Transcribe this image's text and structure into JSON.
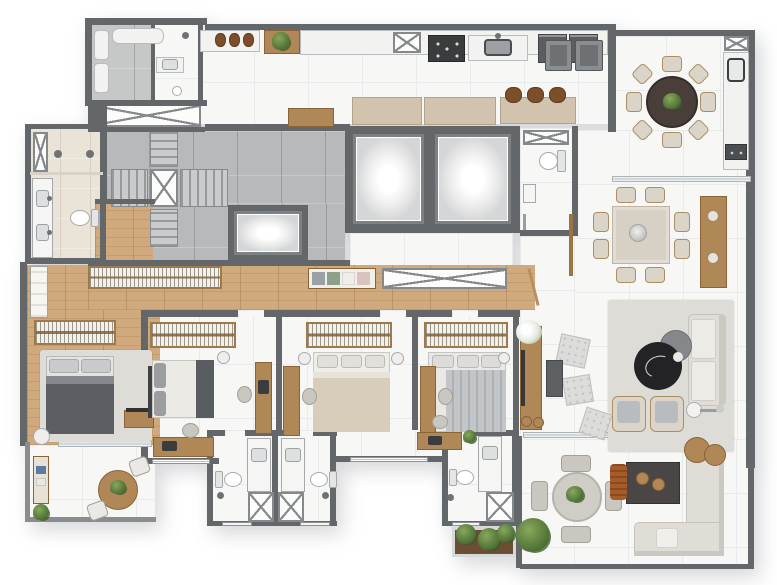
{
  "meta": {
    "kind": "architectural-floor-plan",
    "view": "top-down rendered apartment plan",
    "visible_text": "none"
  },
  "palette": {
    "wall": "#63676a",
    "wallmid": "#8a8d8f",
    "marble": "#f7f7f6",
    "marblegrid": "#e9eaec",
    "wood": "#d0aa7d",
    "concrete": "#b7b9ba",
    "beige": "#eae3d7",
    "furnwood": "#b08756",
    "tan": "#d2c3ae",
    "darkfurn": "#4a4645",
    "sofa": "#e0ddd7",
    "rug": "#dedcd7",
    "green": "#5c7d42",
    "stool_brown": "#7c4e2a",
    "orange": "#a55c28",
    "bed_dark": "#5b5e62",
    "table_dark": "#4a3e3a",
    "coffee_black": "#232225"
  },
  "counts": {
    "bedrooms": 4,
    "bathrooms_total": 6,
    "passenger_elevators": 2,
    "service_elevators": 1,
    "dining_table_seats": 8,
    "balcony_round_table_seats": 8,
    "terrace_round_table_seats": 4,
    "kitchen_bar_stools": 3
  },
  "rooms": [
    {
      "id": "service-room",
      "furniture": [
        "water-heaters",
        "stacked-machines"
      ]
    },
    {
      "id": "service-bathroom",
      "furniture": [
        "shower-head",
        "sink",
        "drain"
      ]
    },
    {
      "id": "laundry",
      "furniture": [
        "counter",
        "baskets",
        "plant-shelf"
      ]
    },
    {
      "id": "kitchen",
      "furniture": [
        "counter",
        "cooktop-5-burners",
        "sink",
        "ovens",
        "bar-counter",
        "bar-stools",
        "cabinets",
        "entry-cabinets"
      ]
    },
    {
      "id": "gourmet-balcony",
      "furniture": [
        "round-dining-table",
        "eight-chairs",
        "counter-sink",
        "grill",
        "duct"
      ]
    },
    {
      "id": "stair-core",
      "furniture": [
        "switchback-stairs",
        "shaft",
        "service-elevator"
      ]
    },
    {
      "id": "elevator-hall",
      "furniture": [
        "elevator-1",
        "elevator-2"
      ]
    },
    {
      "id": "powder-room",
      "furniture": [
        "toilet",
        "sink",
        "duct"
      ]
    },
    {
      "id": "dining-room",
      "furniture": [
        "square-table",
        "eight-chairs",
        "sideboard",
        "slat-partition"
      ]
    },
    {
      "id": "living-room",
      "furniture": [
        "rug",
        "sofa",
        "two-armchairs",
        "black-marble-coffee-table",
        "grey-coffee-table",
        "floor-lamp",
        "quilted-poufs",
        "side-table",
        "tv-console",
        "flowers"
      ]
    },
    {
      "id": "terrace",
      "furniture": [
        "round-table",
        "four-chairs",
        "fire-table",
        "orange-pouf",
        "l-shaped-sofa",
        "wood-side-tables",
        "plant",
        "planter-box"
      ]
    },
    {
      "id": "hallway",
      "furniture": [
        "long-wardrobe",
        "clothes-shelf",
        "linen-closet",
        "door"
      ]
    },
    {
      "id": "master-suite",
      "furniture": [
        "double-bed-dark",
        "rug",
        "wardrobe",
        "shelving",
        "lamp-table",
        "tv-console",
        "plant"
      ]
    },
    {
      "id": "master-bathroom",
      "furniture": [
        "double-vanity",
        "two-shower-heads",
        "toilet",
        "shaft"
      ]
    },
    {
      "id": "master-balcony",
      "furniture": [
        "bistro-table",
        "two-chairs",
        "console",
        "plant-pot"
      ]
    },
    {
      "id": "bedroom-2",
      "furniture": [
        "wardrobe",
        "double-bed-white",
        "tv-panel",
        "desk-bottom",
        "desk-side",
        "chairs",
        "lamp-table"
      ]
    },
    {
      "id": "bedroom-3",
      "furniture": [
        "wardrobe",
        "double-bed-tan",
        "desk-side",
        "chair",
        "lamp-tables"
      ]
    },
    {
      "id": "bedroom-4",
      "furniture": [
        "wardrobe",
        "double-bed-striped",
        "desk-side",
        "desk-bottom",
        "chairs",
        "plant"
      ]
    },
    {
      "id": "bathroom-2",
      "furniture": [
        "vanity",
        "toilet",
        "shower-box",
        "window"
      ]
    },
    {
      "id": "bathroom-3",
      "furniture": [
        "vanity",
        "toilet",
        "shower-box",
        "window"
      ]
    },
    {
      "id": "bathroom-4",
      "furniture": [
        "vanity",
        "toilet",
        "shower-box",
        "window"
      ]
    }
  ]
}
